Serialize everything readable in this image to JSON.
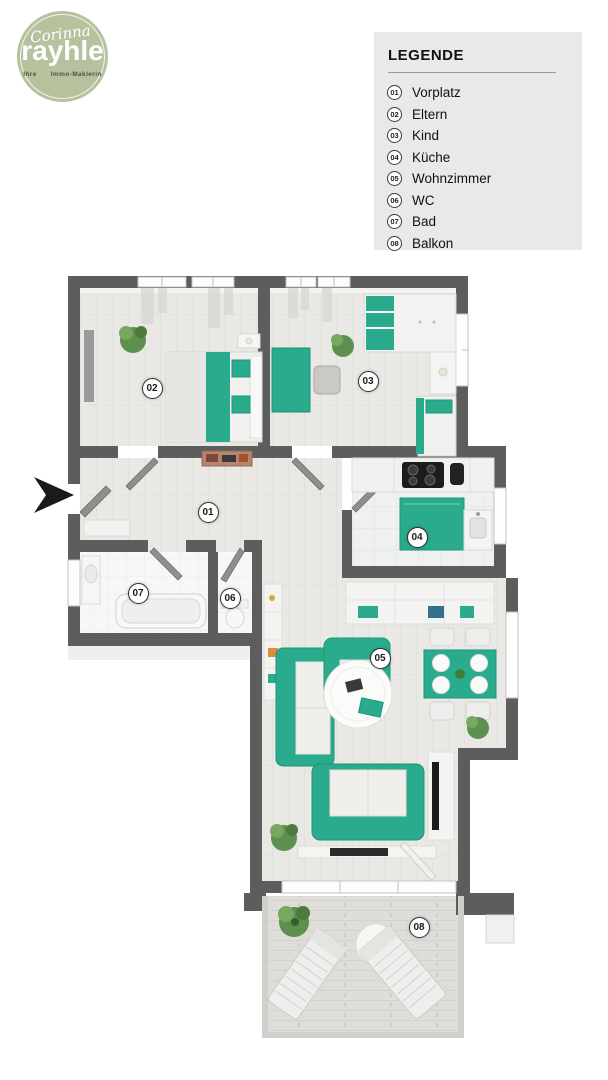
{
  "logo": {
    "script_name": "Corinna",
    "brand": "rayhle",
    "tagline_left": "Ihre",
    "tagline_right": "Immo-Maklerin"
  },
  "legend": {
    "title": "LEGENDE",
    "items": [
      {
        "num": "01",
        "label": "Vorplatz"
      },
      {
        "num": "02",
        "label": "Eltern"
      },
      {
        "num": "03",
        "label": "Kind"
      },
      {
        "num": "04",
        "label": "Küche"
      },
      {
        "num": "05",
        "label": "Wohnzimmer"
      },
      {
        "num": "06",
        "label": "WC"
      },
      {
        "num": "07",
        "label": "Bad"
      },
      {
        "num": "08",
        "label": "Balkon"
      }
    ]
  },
  "floorplan": {
    "markers": [
      {
        "num": "01",
        "room": "Vorplatz"
      },
      {
        "num": "02",
        "room": "Eltern"
      },
      {
        "num": "03",
        "room": "Kind"
      },
      {
        "num": "04",
        "room": "Küche"
      },
      {
        "num": "05",
        "room": "Wohnzimmer"
      },
      {
        "num": "06",
        "room": "WC"
      },
      {
        "num": "07",
        "room": "Bad"
      },
      {
        "num": "08",
        "room": "Balkon"
      }
    ]
  },
  "colors": {
    "accent_teal": "#2aab8d",
    "wall_gray": "#5d5d5d",
    "legend_bg": "#e9e9e9",
    "logo_green": "#b6c29e"
  }
}
